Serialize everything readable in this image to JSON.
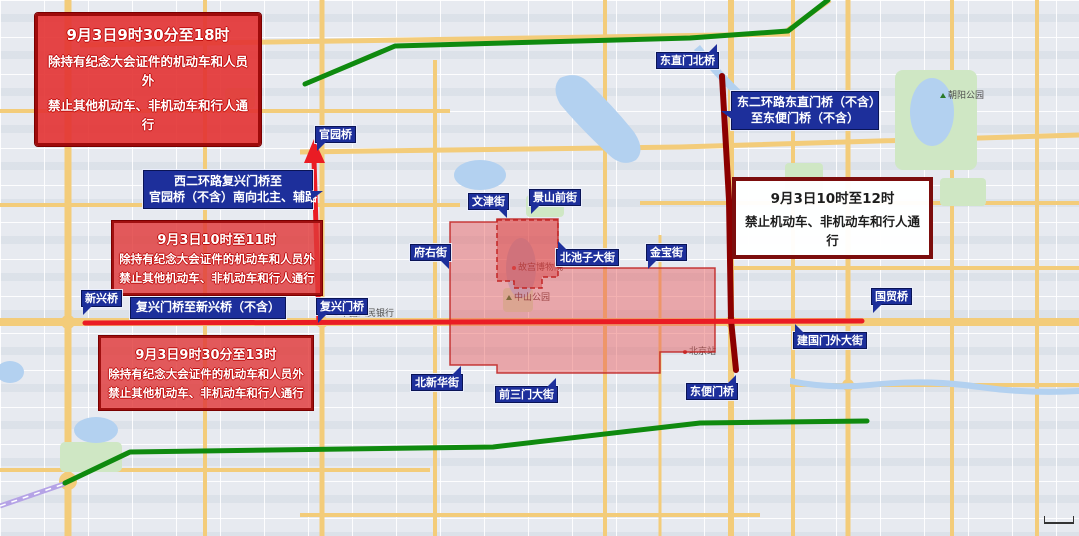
{
  "notices": {
    "top_left": {
      "line1": "9月3日9时30分至18时",
      "line2": "除持有纪念大会证件的机动车和人员外",
      "line3": "禁止其他机动车、非机动车和行人通行"
    },
    "west_ring": {
      "line1": "西二环路复兴门桥至",
      "line2": "官园桥（不含）南向北主、辅路"
    },
    "mid_west": {
      "line1": "9月3日10时至11时",
      "line2": "除持有纪念大会证件的机动车和人员外",
      "line3": "禁止其他机动车、非机动车和行人通行"
    },
    "fuxing_to_xinxing": {
      "line1": "复兴门桥至新兴桥（不含）"
    },
    "south_west": {
      "line1": "9月3日9时30分至13时",
      "line2": "除持有纪念大会证件的机动车和人员外",
      "line3": "禁止其他机动车、非机动车和行人通行"
    },
    "east_ring": {
      "line1": "东二环路东直门桥（不含）",
      "line2": "至东便门桥（不含）"
    },
    "east_time": {
      "line1": "9月3日10时至12时",
      "line2": "禁止机动车、非机动车和行人通行"
    }
  },
  "road_labels": {
    "dongzhimen_north_bridge": "东直门北桥",
    "guanyuan_bridge": "官园桥",
    "wenjin_street": "文津街",
    "jingshanqian_street": "景山前街",
    "fuyou_street": "府右街",
    "beichizi_street": "北池子大街",
    "jinbao_street": "金宝街",
    "xinxing_bridge": "新兴桥",
    "fuxingmen_bridge": "复兴门桥",
    "guomao_bridge": "国贸桥",
    "jianguomenwai_street": "建国门外大街",
    "beixinhua_street": "北新华街",
    "qiansanmen_street": "前三门大街",
    "dongbianmen_bridge": "东便门桥"
  },
  "base_map_labels": {
    "chaoyang_park": "朝阳公园",
    "beijing_station": "北京站",
    "zhongshan_park": "中山公园",
    "palace_museum": "故宫博物院",
    "peoples_bank": "中国人民银行"
  },
  "overlay_colors": {
    "route_red": "#ea1c24",
    "route_green": "#0f8a0f",
    "route_dark_red": "#8b0000",
    "label_blue": "#1d2f9b",
    "zone_fill_red": "#e05050",
    "notice_border_red": "#9e0b0b",
    "white_notice_border": "#7c0d0d"
  }
}
